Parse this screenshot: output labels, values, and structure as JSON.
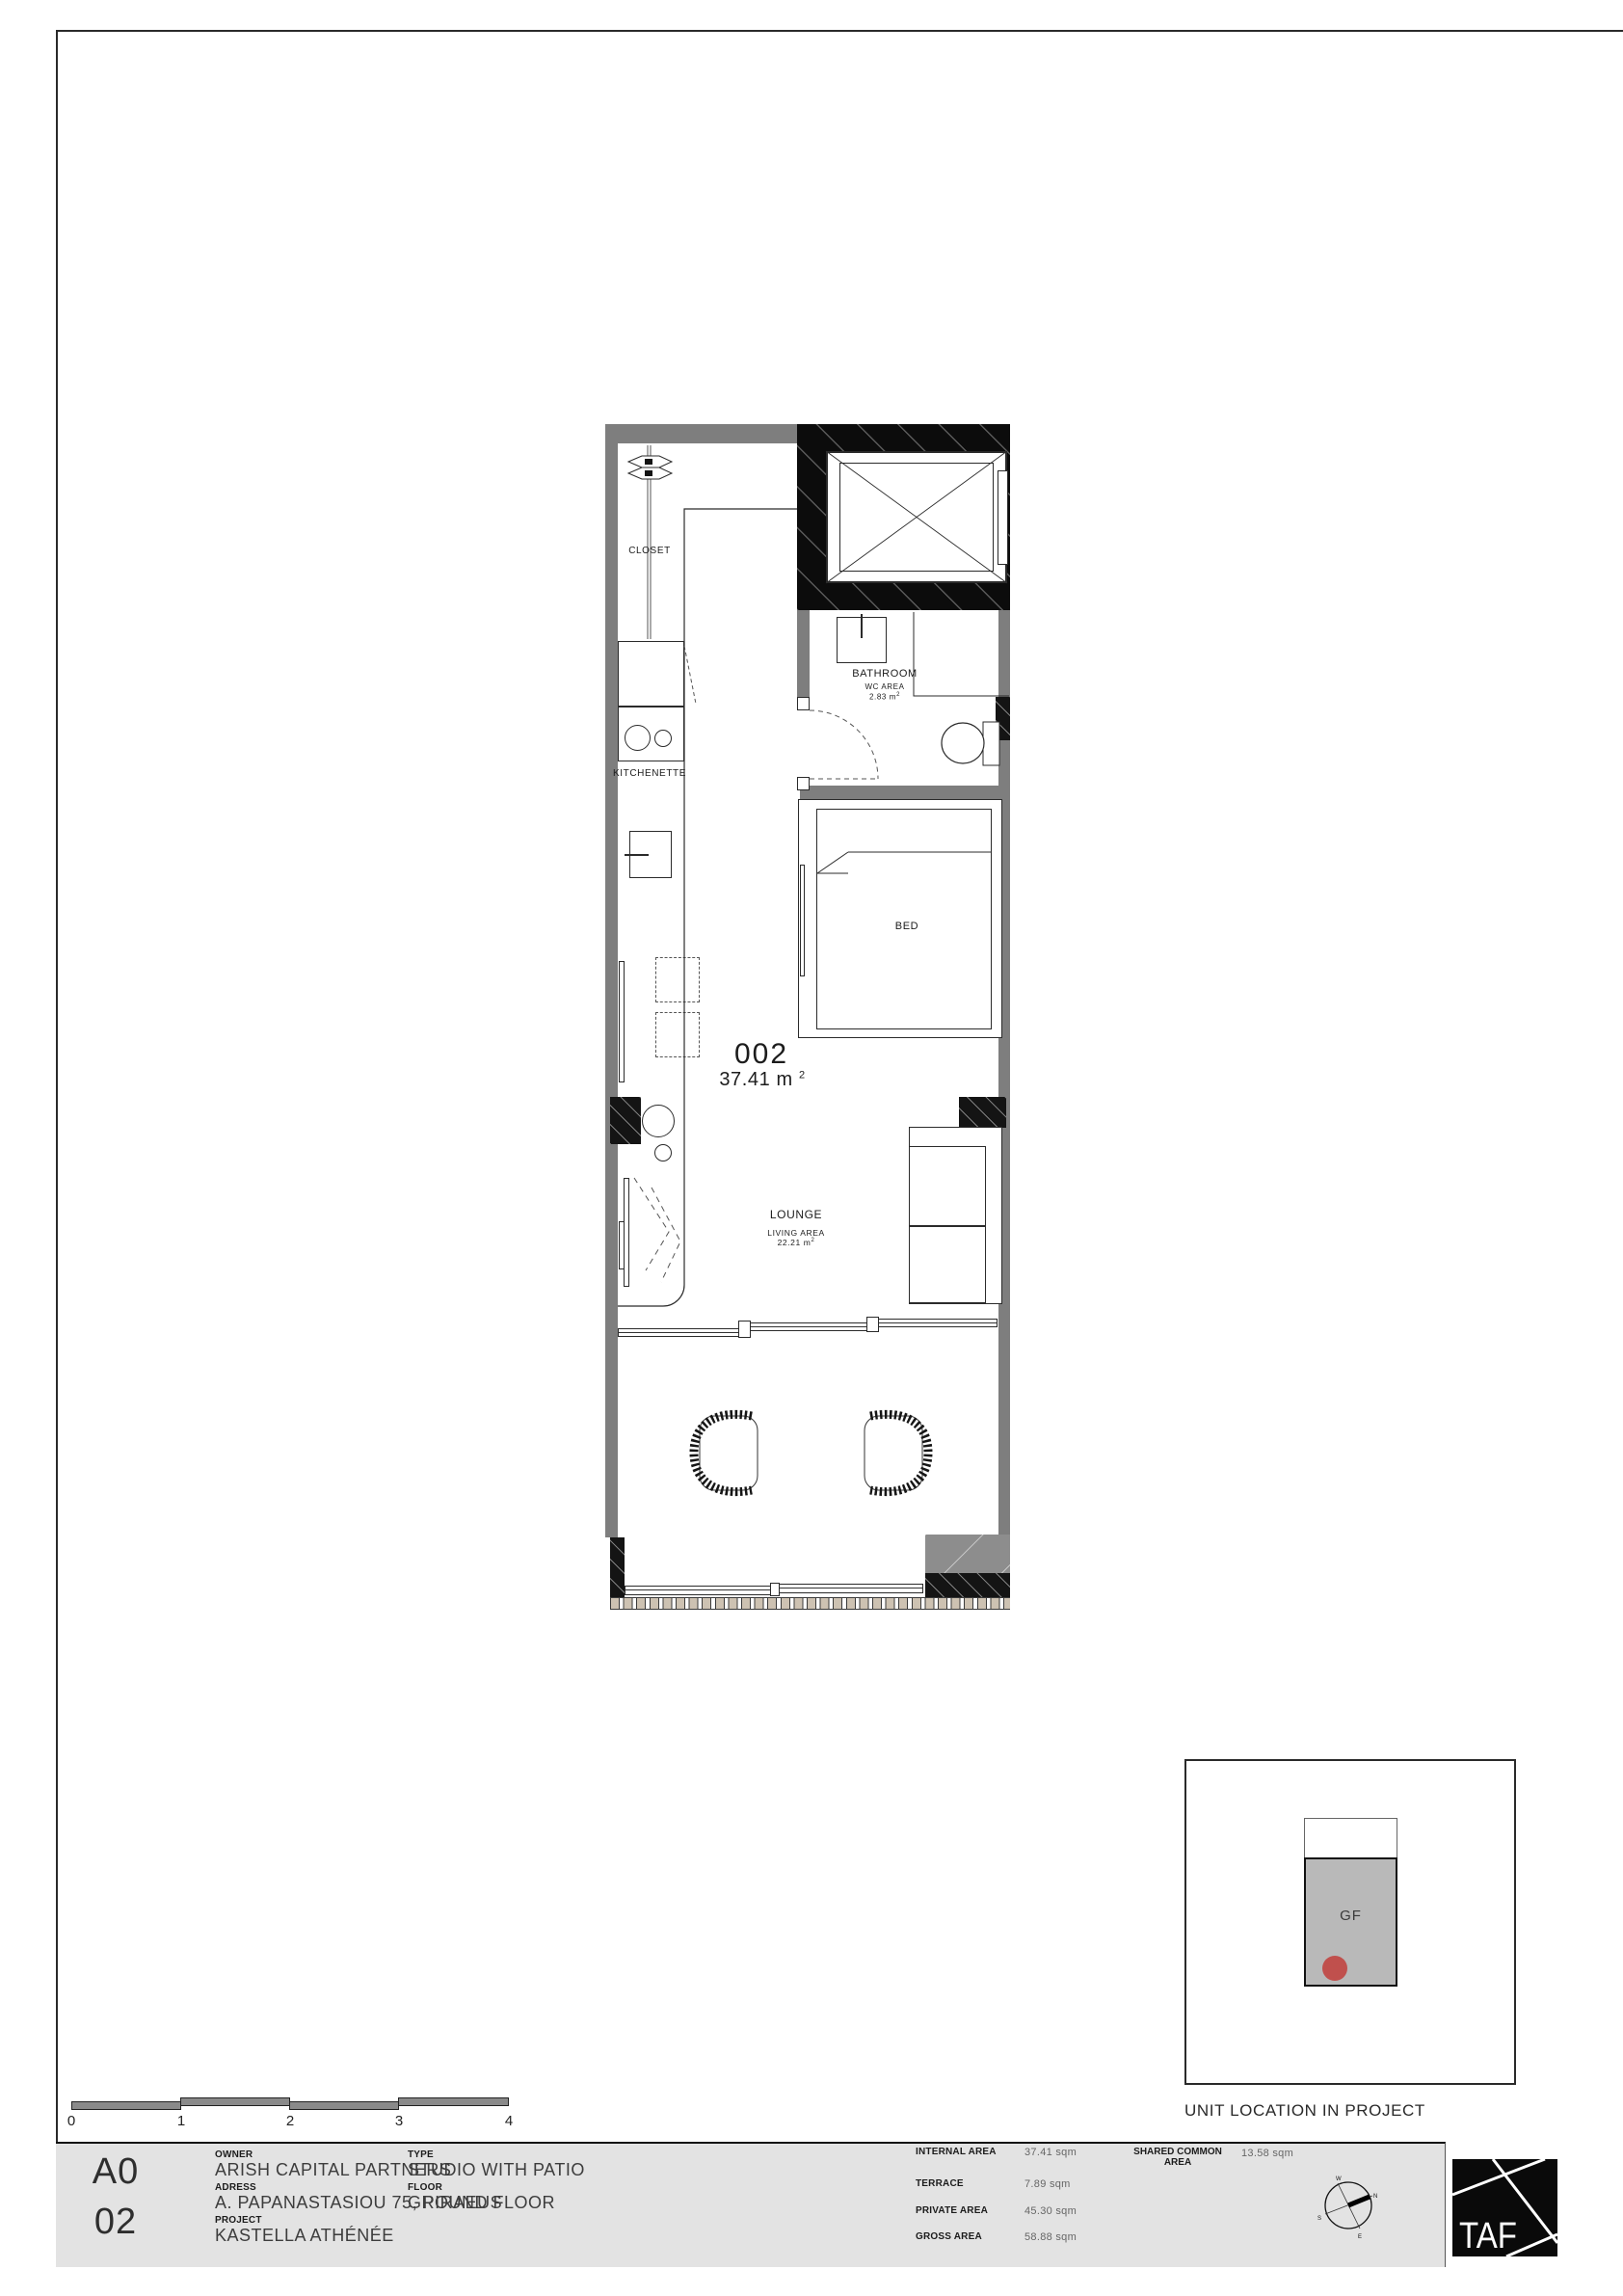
{
  "plan": {
    "unit_number": "002",
    "unit_area_value": "37.41 m",
    "unit_area_sup": "2",
    "labels": {
      "closet": "CLOSET",
      "kitchenette": "KITCHENETTE",
      "bed": "BED",
      "bathroom_name": "BATHROOM",
      "bathroom_sub": "WC AREA",
      "bathroom_area_value": "2.83 m",
      "bathroom_area_sup": "2",
      "lounge_name": "LOUNGE",
      "lounge_sub": "LIVING AREA",
      "lounge_area_value": "22.21 m",
      "lounge_area_sup": "2"
    }
  },
  "unit_location": {
    "caption": "UNIT LOCATION IN PROJECT",
    "floor_label": "GF",
    "marker_color": "#c0504d"
  },
  "scale_bar": {
    "ticks": [
      "0",
      "1",
      "2",
      "3",
      "4"
    ]
  },
  "title_block": {
    "sheet_series": "A0",
    "sheet_number": "02",
    "owner_label": "OWNER",
    "owner_value": "ARISH CAPITAL PARTNERS",
    "address_label": "ADRESS",
    "address_value": "A. PAPANASTASIOU 75, PIRAEUS",
    "project_label": "PROJECT",
    "project_value": "KASTELLA ATHÉNÉE",
    "type_label": "TYPE",
    "type_value": "STUDIO WITH PATIO",
    "floor_label": "FLOOR",
    "floor_value": "GROUND FLOOR",
    "areas": [
      {
        "label": "INTERNAL AREA",
        "value": "37.41 sqm"
      },
      {
        "label": "TERRACE",
        "value": "7.89 sqm"
      },
      {
        "label": "PRIVATE AREA",
        "value": "45.30 sqm"
      },
      {
        "label": "GROSS AREA",
        "value": "58.88 sqm"
      }
    ],
    "shared_label_line1": "SHARED COMMON",
    "shared_label_line2": "AREA",
    "shared_value": "13.58 sqm",
    "compass": {
      "n": "N",
      "e": "E",
      "s": "S",
      "w": "W"
    },
    "logo_text": "TAF"
  },
  "colors": {
    "wall_gray": "#7e7e7e",
    "structure_black": "#141414",
    "titleblock_gray": "#e3e3e3",
    "marker_red": "#c0504d"
  }
}
